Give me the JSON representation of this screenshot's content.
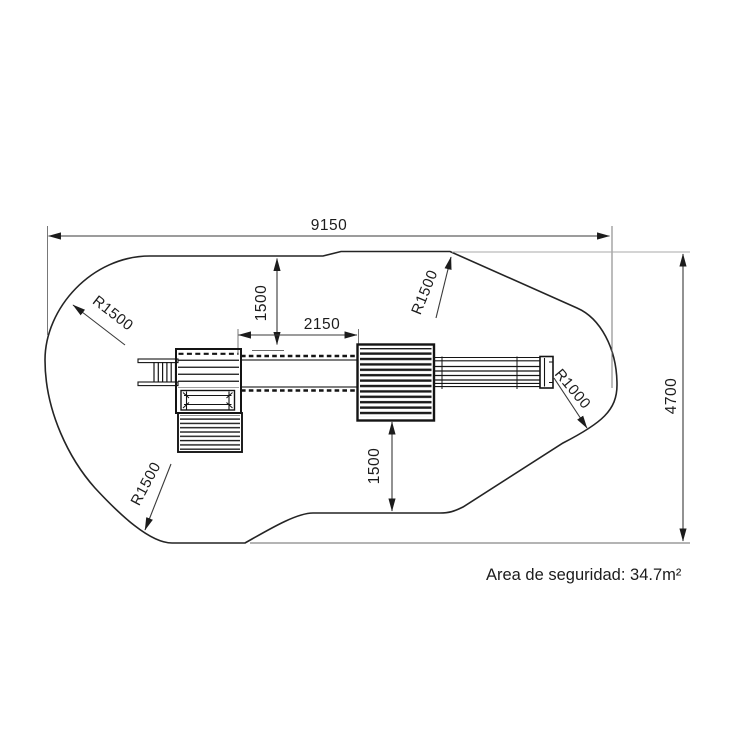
{
  "diagram": {
    "kind": "playground-safety-area-plan",
    "dimensions": {
      "overall_width": "9150",
      "overall_height": "4700",
      "top_offset": "1500",
      "bridge_length": "2150",
      "bottom_offset": "1500"
    },
    "radii": {
      "top_left": "R1500",
      "top_middle": "R1500",
      "bottom_left": "R1500",
      "right": "R1000"
    },
    "caption": "Area de seguridad: 34.7m²",
    "colors": {
      "line": "#242424",
      "dimension_line": "#3a3a3a",
      "background": "#ffffff"
    }
  }
}
